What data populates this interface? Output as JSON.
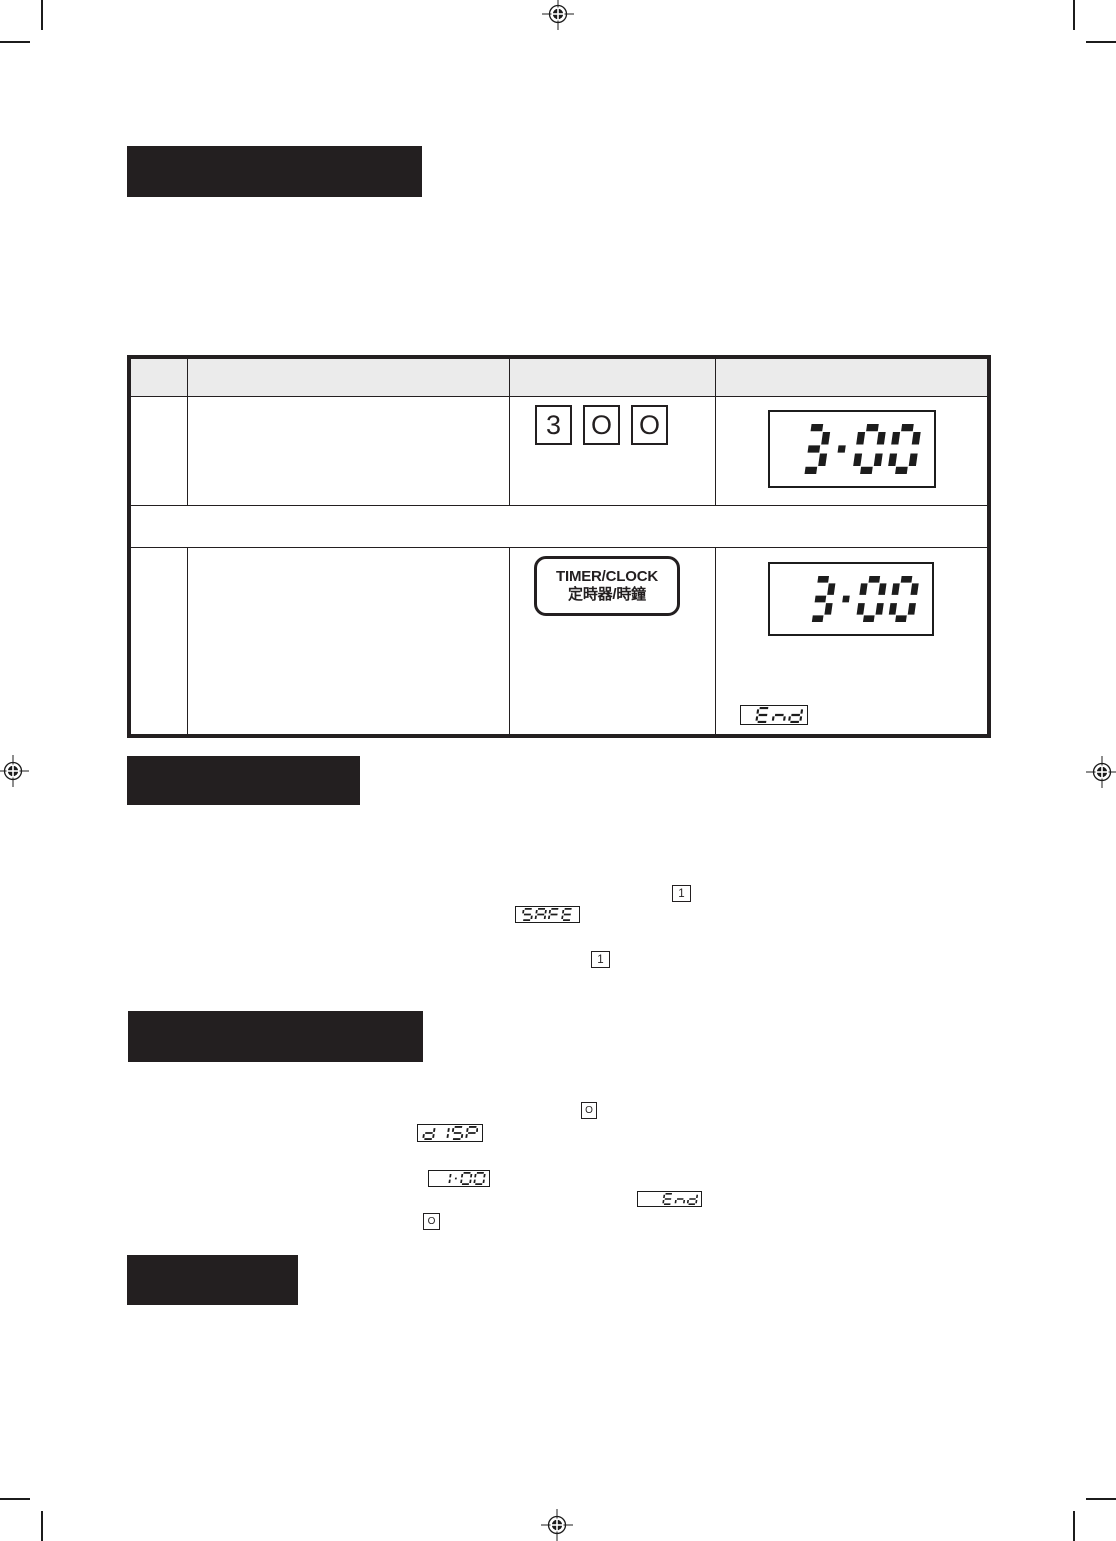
{
  "colors": {
    "ink": "#231f20",
    "segment": "#1c1c1c",
    "table_header_bg": "#ebebeb",
    "paper": "#ffffff"
  },
  "icons": {
    "registration_mark": "crosshair-target-circle",
    "crop_mark": "thin-black-line",
    "dial_key": "circle-outline"
  },
  "section_bars": [
    {
      "label": ""
    },
    {
      "label": ""
    },
    {
      "label": ""
    },
    {
      "label": ""
    }
  ],
  "table": {
    "header": {
      "col1": "",
      "col2": "",
      "col3": "",
      "col4": ""
    },
    "rows": {
      "step1": {
        "keys": [
          "3",
          "O",
          "O"
        ],
        "display_value": "3:00"
      },
      "note": {
        "text": ""
      },
      "step2": {
        "button_line1": "TIMER/CLOCK",
        "button_line2": "定時器/時鐘",
        "display_value": "3:00",
        "status_display_value": "End"
      }
    }
  },
  "safe_section": {
    "key_top": "1",
    "display_value": "SAFE",
    "key_bottom": "1"
  },
  "display_section": {
    "key_top": "O",
    "display_value_1": "dISP",
    "display_value_2": "1:00",
    "display_value_3": "End",
    "key_bottom": "O"
  }
}
